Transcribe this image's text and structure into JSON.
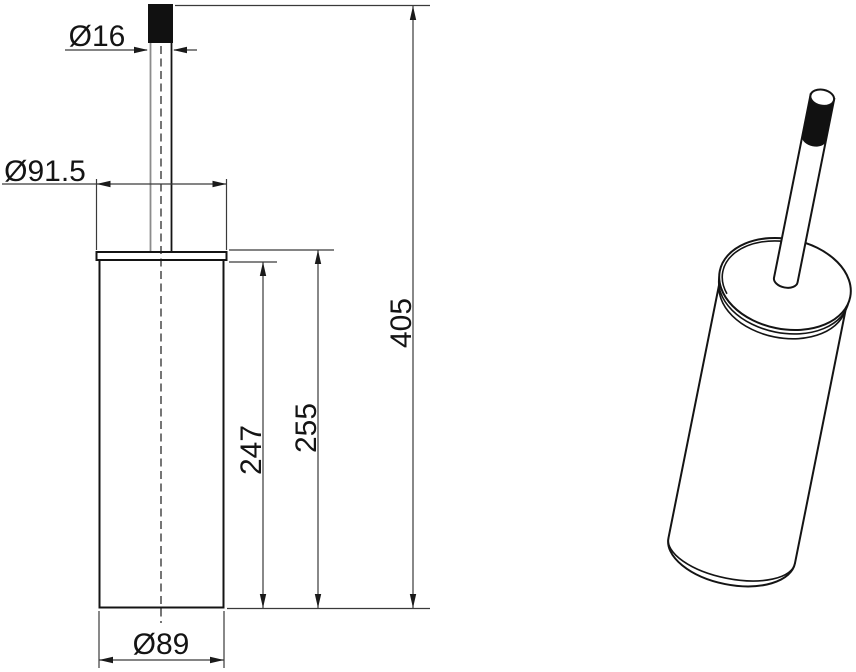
{
  "dimensions": {
    "handle_diameter": "Ø16",
    "head_diameter": "Ø91.5",
    "container_height": "247",
    "container_with_lid_height": "255",
    "overall_height": "405",
    "container_diameter": "Ø89"
  },
  "colors": {
    "object_line": "#141414",
    "dimension_line": "#3a3a3a",
    "light_line": "#8c8c8c",
    "handle_fill": "#111111",
    "background": "#ffffff"
  }
}
